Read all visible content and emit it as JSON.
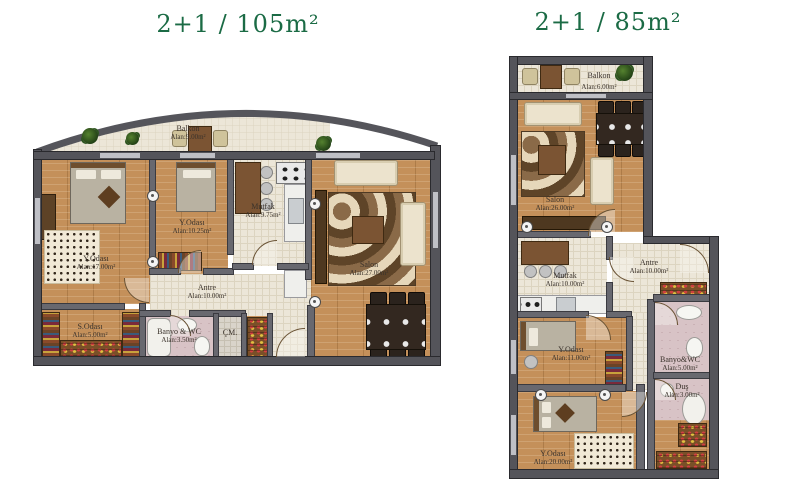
{
  "left_plan": {
    "title": "2+1 / 105m²",
    "rooms": {
      "balkon": {
        "name": "Balkon",
        "area": "Alan:9.00m²"
      },
      "yatak_odasi_buyuk": {
        "name": "Y.Odası",
        "area": "Alan:17.00m²"
      },
      "yatak_odasi_kucuk": {
        "name": "Y.Odası",
        "area": "Alan:10.25m²"
      },
      "mutfak": {
        "name": "Mutfak",
        "area": "Alan:9.75m²"
      },
      "salon": {
        "name": "Salon",
        "area": "Alan:27.00m²"
      },
      "antre": {
        "name": "Antre",
        "area": "Alan:10.00m²"
      },
      "sandik_odasi": {
        "name": "S.Odası",
        "area": "Alan:5.00m²"
      },
      "banyo_wc": {
        "name": "Banyo & WC",
        "area": "Alan:3.50m²"
      },
      "camasir": {
        "name": "ÇM."
      }
    }
  },
  "right_plan": {
    "title": "2+1 / 85m²",
    "rooms": {
      "balkon": {
        "name": "Balkon",
        "area": "Alan:6.00m²"
      },
      "salon": {
        "name": "Salon",
        "area": "Alan:26.00m²"
      },
      "mutfak": {
        "name": "Mutfak",
        "area": "Alan:10.00m²"
      },
      "antre": {
        "name": "Antre",
        "area": "Alan:10.00m²"
      },
      "yatak_odasi_orta": {
        "name": "Y.Odası",
        "area": "Alan:11.00m²"
      },
      "banyo_wc": {
        "name": "Banyo&WC",
        "area": "Alan:5.00m²"
      },
      "dus": {
        "name": "Duş",
        "area": "Alan:3.00m²"
      },
      "yatak_odasi_buyuk": {
        "name": "Y.Odası",
        "area": "Alan:20.00m²"
      }
    }
  },
  "palette": {
    "title_green": "#1b6b45",
    "wall_gray": "#54545a",
    "wood_floor": "#c4905a",
    "tile_floor": "#ece6d8",
    "bath_tile": "#d8c3c6",
    "sofa_cream": "#ece3cd",
    "furniture_brown": "#7b5433",
    "plant_green": "#2e5520"
  }
}
